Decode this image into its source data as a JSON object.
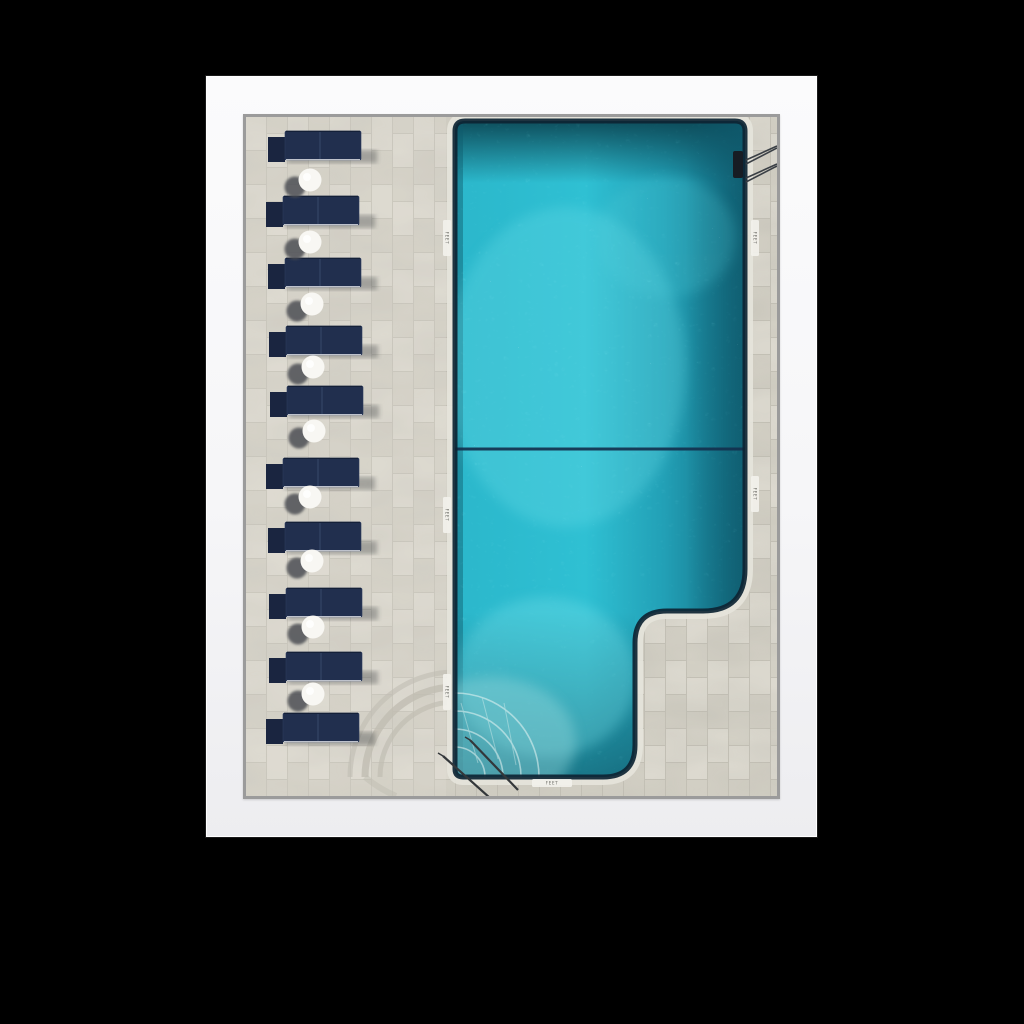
{
  "scene": {
    "description_name": "framed-aerial-pool-print",
    "background_color": "#000000",
    "frame": {
      "mat_color": "#f7f7f8",
      "photo_border_color": "#9b9b9b"
    },
    "photo": {
      "deck": {
        "base_color": "#d6d3c9",
        "joint_color": "#c3c0b5",
        "coping_color": "#e6e4db"
      },
      "water": {
        "bright": "#2fc0d3",
        "mid": "#23a4ba",
        "deep": "#156c7e",
        "top_band": "#0c4856",
        "outline": "#0d2433",
        "sparkle": "#eafcff"
      },
      "lane_line_color": "#14314e",
      "loungers": {
        "color": "#212f4e",
        "count": 10,
        "positions": [
          [
            29,
            13
          ],
          [
            27,
            78
          ],
          [
            29,
            140
          ],
          [
            30,
            208
          ],
          [
            31,
            268
          ],
          [
            27,
            340
          ],
          [
            29,
            404
          ],
          [
            30,
            470
          ],
          [
            30,
            534
          ],
          [
            27,
            595
          ]
        ]
      },
      "umbrellas": {
        "white_color": "#f8f7f3",
        "shadow_color": "#4e5054",
        "count": 9,
        "centers": [
          [
            64,
            63
          ],
          [
            64,
            125
          ],
          [
            66,
            187
          ],
          [
            67,
            250
          ],
          [
            68,
            314
          ],
          [
            64,
            380
          ],
          [
            66,
            444
          ],
          [
            67,
            510
          ],
          [
            67,
            577
          ]
        ]
      },
      "depth_markers": [
        {
          "label": "FEET",
          "x": 201,
          "y": 121,
          "vertical": true
        },
        {
          "label": "FEET",
          "x": 509,
          "y": 121,
          "vertical": true
        },
        {
          "label": "FEET",
          "x": 201,
          "y": 398,
          "vertical": true
        },
        {
          "label": "FEET",
          "x": 509,
          "y": 377,
          "vertical": true
        },
        {
          "label": "FEET",
          "x": 201,
          "y": 575,
          "vertical": true
        },
        {
          "label": "FEET",
          "x": 306,
          "y": 666,
          "vertical": false
        }
      ]
    }
  }
}
